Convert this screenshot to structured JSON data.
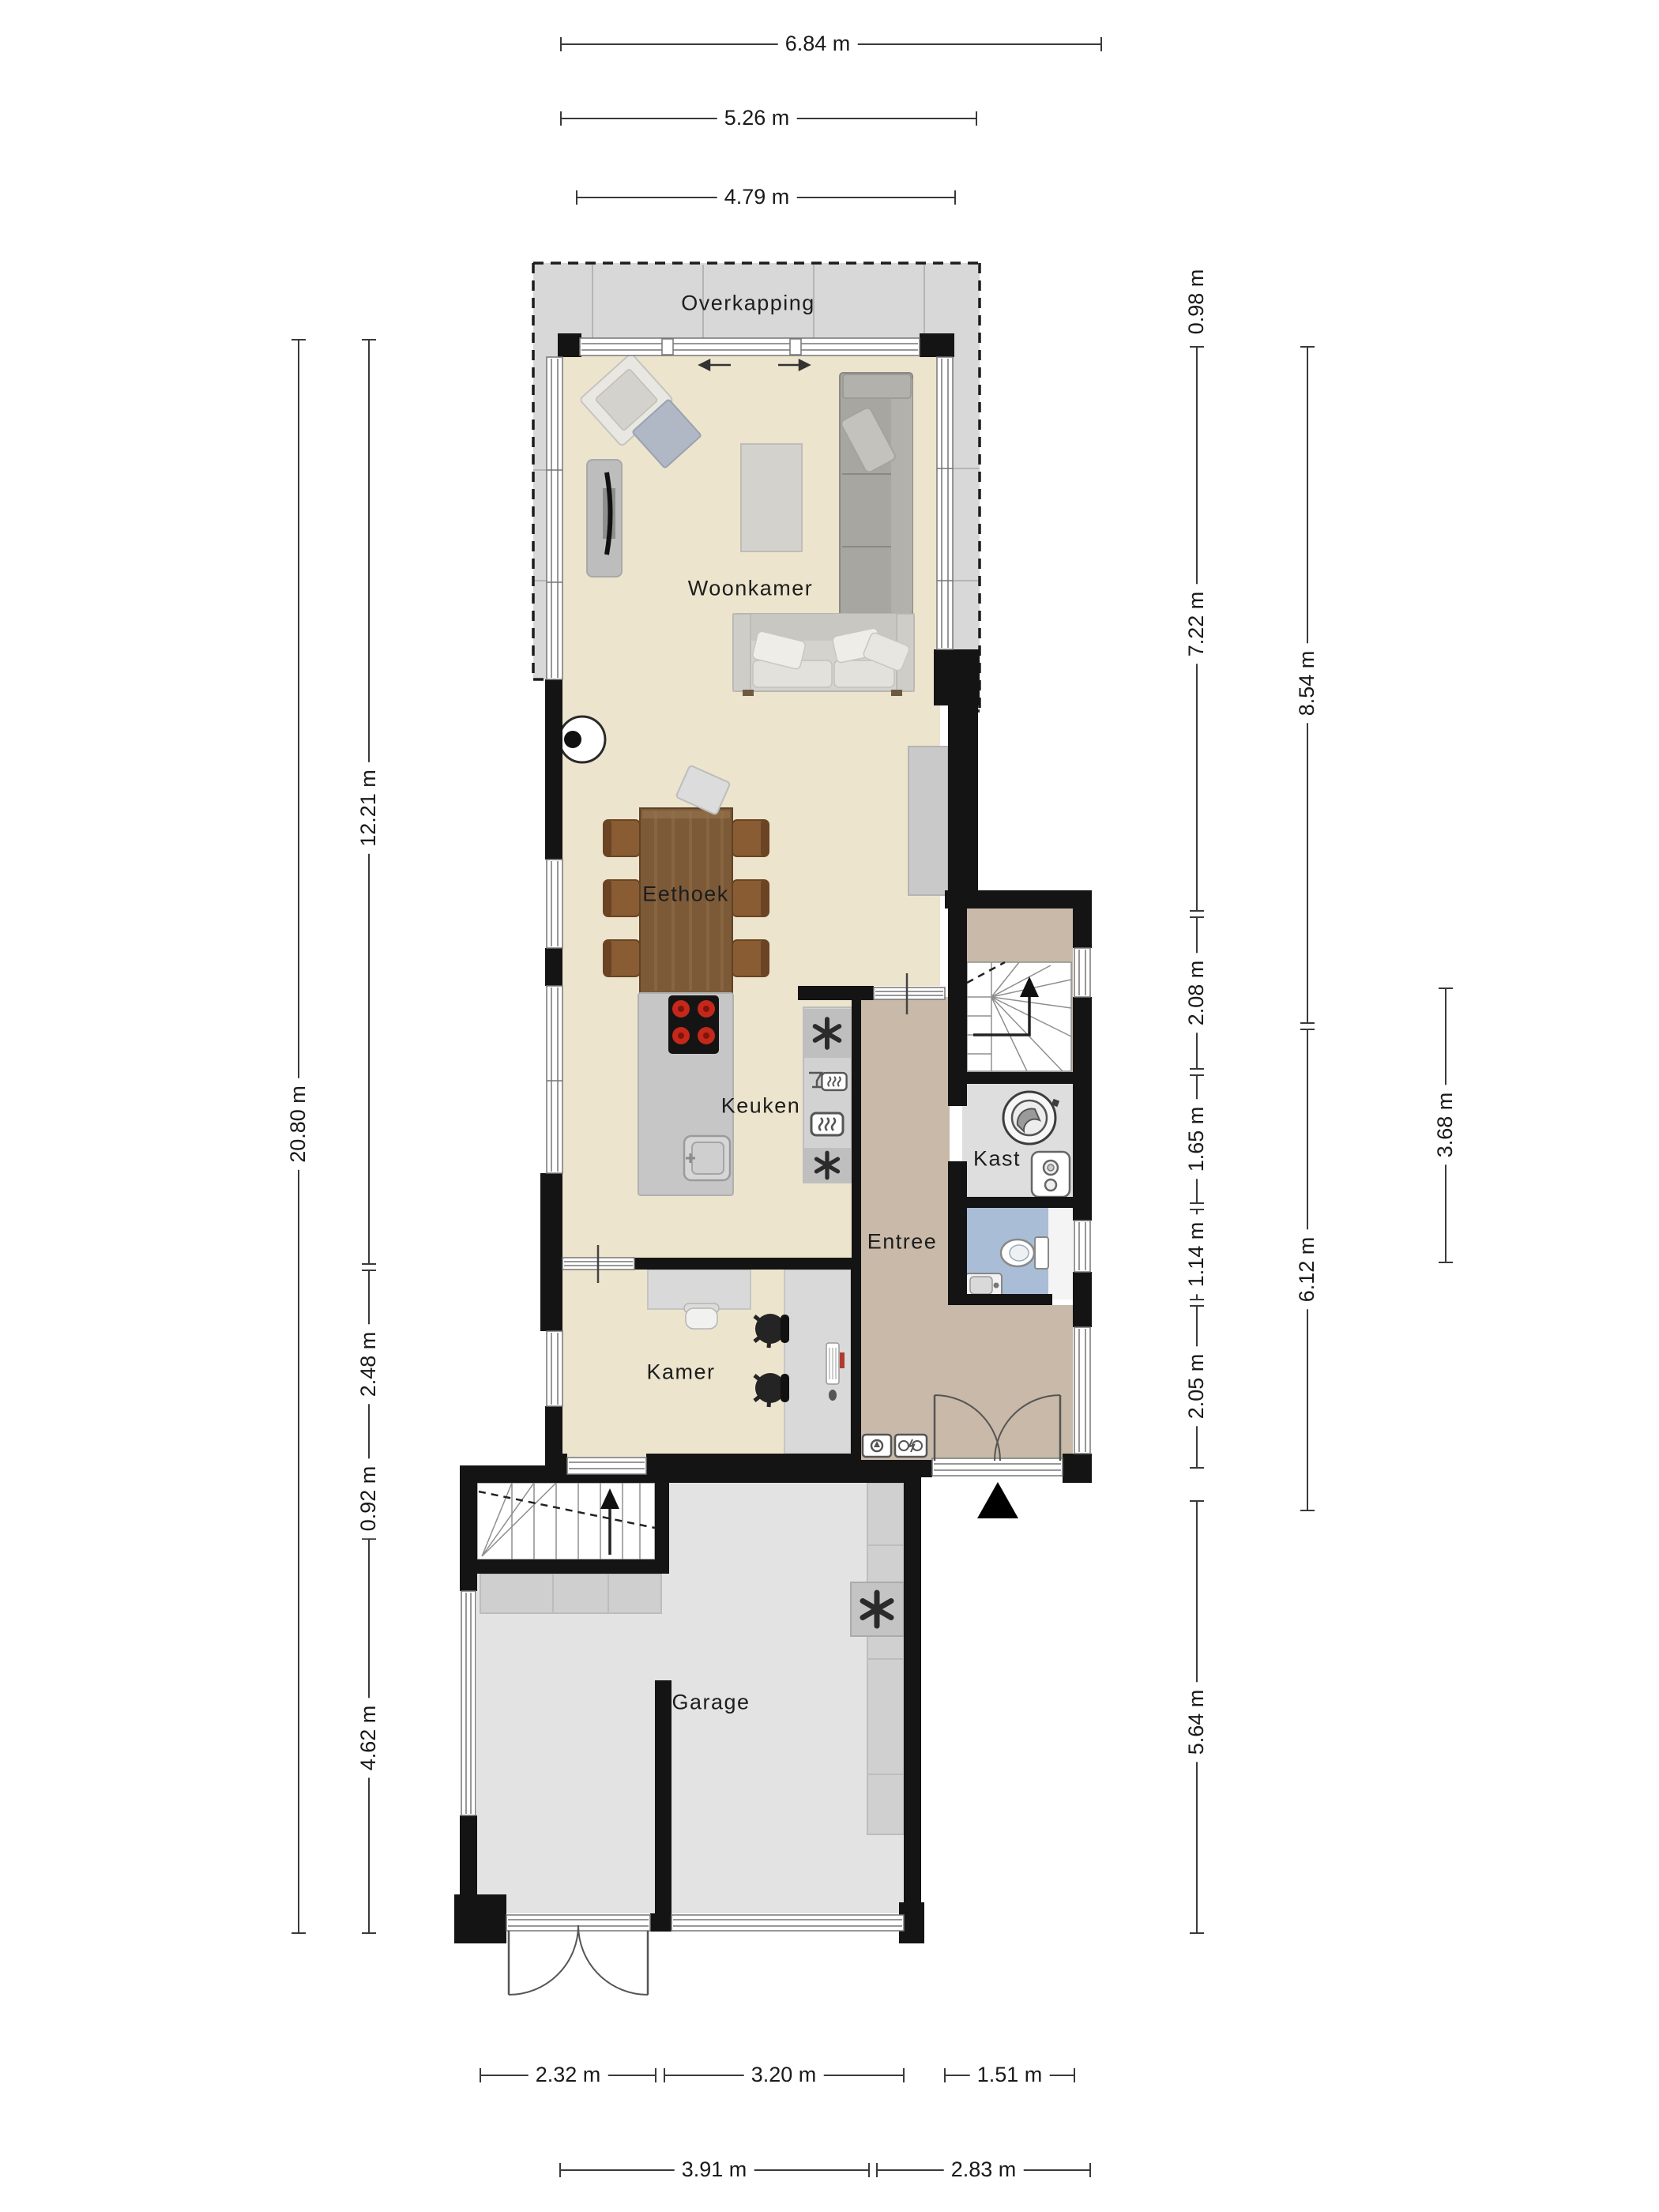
{
  "rooms": {
    "overkapping": "Overkapping",
    "woonkamer": "Woonkamer",
    "eethoek": "Eethoek",
    "keuken": "Keuken",
    "kast": "Kast",
    "entree": "Entree",
    "kamer": "Kamer",
    "garage": "Garage"
  },
  "dimensions": {
    "top": [
      "6.84 m",
      "5.26 m",
      "4.79 m"
    ],
    "left": [
      "20.80 m",
      "12.21 m",
      "2.48 m",
      "0.92 m",
      "4.62 m"
    ],
    "right": [
      "0.98 m",
      "7.22 m",
      "2.08 m",
      "1.65 m",
      "1.14 m",
      "2.05 m",
      "5.64 m",
      "8.54 m",
      "6.12 m",
      "3.68 m"
    ],
    "bottom": [
      "2.32 m",
      "3.20 m",
      "1.51 m",
      "3.91 m",
      "2.83 m"
    ]
  },
  "colors": {
    "wall": "#141414",
    "floor_living": "#ece4cd",
    "floor_hall": "#c8b9a8",
    "floor_closet": "#dedede",
    "floor_toilet": "#a9bdd6",
    "floor_garage": "#e3e3e3",
    "canopy": "#d8d8d8",
    "wood_table": "#7c5a38",
    "chair_wood": "#8a5c33",
    "burner": "#c5271b"
  }
}
